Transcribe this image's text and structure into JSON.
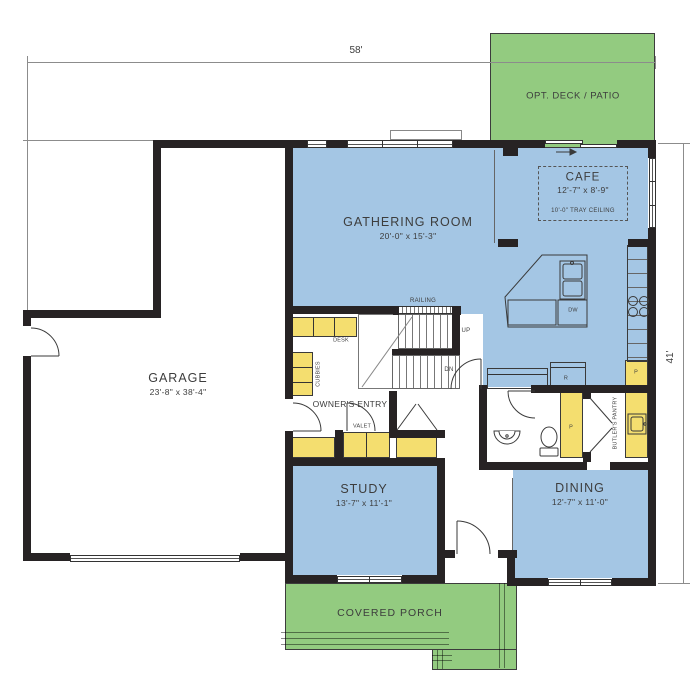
{
  "title": "First Floor Plan",
  "colors": {
    "wall": "#272324",
    "room_blue": "#a4c6e4",
    "cabinet_yellow": "#f4de6f",
    "outdoor_green": "#93cb80",
    "text": "#3d3d3d"
  },
  "dimensions": {
    "width_label": "58'",
    "depth_label": "41'"
  },
  "outdoor": {
    "deck_label": "OPT. DECK / PATIO",
    "porch_label": "COVERED PORCH"
  },
  "rooms": {
    "gathering": {
      "name": "GATHERING ROOM",
      "size": "20'-0\" x 15'-3\""
    },
    "cafe": {
      "name": "CAFE",
      "size": "12'-7\" x 8'-9\"",
      "note": "10'-0\" TRAY CEILING"
    },
    "garage": {
      "name": "GARAGE",
      "size": "23'-8\" x 38'-4\""
    },
    "study": {
      "name": "STUDY",
      "size": "13'-7\" x 11'-1\""
    },
    "dining": {
      "name": "DINING",
      "size": "12'-7\" x 11'-0\""
    },
    "owners_entry": {
      "name": "OWNER'S ENTRY"
    },
    "butlers_pantry": {
      "name": "BUTLER'S PANTRY"
    }
  },
  "annotations": {
    "railing": "RAILING",
    "up": "UP",
    "down": "DN",
    "desk": "DESK",
    "cubbies": "CUBBIES",
    "valet": "VALET",
    "dishwasher": "DW",
    "refrigerator": "R",
    "pantry": "P",
    "pantry2": "P"
  }
}
